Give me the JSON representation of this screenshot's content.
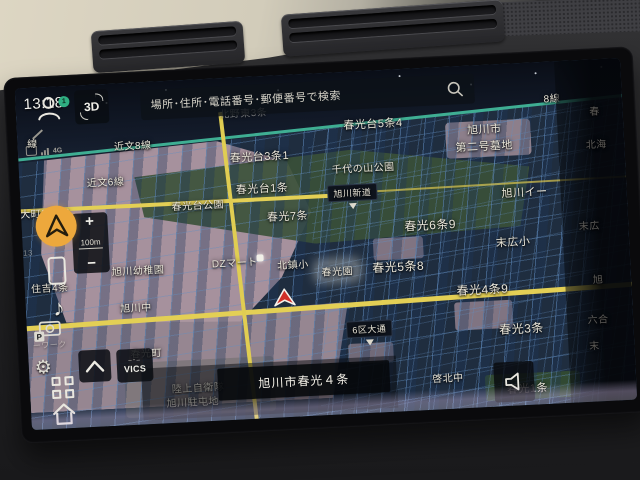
{
  "colors": {
    "accent_orange": "#eda83c",
    "badge_green": "#2fae82",
    "road_yellow": "#e3cf55",
    "road_teal": "#3fae93",
    "map_bg": "#1f2d3f",
    "pink_area": "#b29aa5",
    "park_green": "#3a5138",
    "marker_red": "#d03028"
  },
  "status": {
    "time": "13:18",
    "network_label": "4G"
  },
  "topbar": {
    "view_3d_label": "3D",
    "search_placeholder": "場所･住所･電話番号･郵便番号で検索"
  },
  "zoom_control": {
    "zoom_in": "+",
    "scale": "100m",
    "zoom_out": "−"
  },
  "bottom": {
    "vics_label": "VICS",
    "vics_marks": "–･–",
    "current_address": "旭川市春光４条"
  },
  "sidebar": {
    "profile_badge": "1",
    "music_glyph": "♪"
  },
  "left_icons": {
    "gear_glyph": "⚙",
    "camera_p_label": "P"
  },
  "map": {
    "labels": [
      {
        "t": "線",
        "x": 15,
        "y": 55,
        "c": ""
      },
      {
        "t": "近文8線",
        "x": 115,
        "y": 62,
        "c": ""
      },
      {
        "t": "北野東3条",
        "x": 227,
        "y": 35,
        "c": "dim"
      },
      {
        "t": "8線",
        "x": 536,
        "y": 36,
        "c": ""
      },
      {
        "t": "春光台5条4",
        "x": 356,
        "y": 53,
        "c": "lg"
      },
      {
        "t": "旭川市",
        "x": 467,
        "y": 64,
        "c": "lg"
      },
      {
        "t": "第二号墓地",
        "x": 466,
        "y": 81,
        "c": "lg"
      },
      {
        "t": "春光台3条1",
        "x": 241,
        "y": 80,
        "c": "lg"
      },
      {
        "t": "近文6線",
        "x": 86,
        "y": 97,
        "c": ""
      },
      {
        "t": "千代の山公園",
        "x": 344,
        "y": 96,
        "c": ""
      },
      {
        "t": "春光台1条",
        "x": 242,
        "y": 112,
        "c": "lg"
      },
      {
        "t": "春光台公園",
        "x": 177,
        "y": 125,
        "c": ""
      },
      {
        "t": "春光7条",
        "x": 266,
        "y": 141,
        "c": "lg"
      },
      {
        "t": "大町2条18",
        "x": 24,
        "y": 125,
        "c": ""
      },
      {
        "t": "旭川イー",
        "x": 504,
        "y": 129,
        "c": "lg"
      },
      {
        "t": "旭川新道",
        "x": 332,
        "y": 121,
        "c": "sign"
      },
      {
        "t": "春光6条9",
        "x": 408,
        "y": 157,
        "c": "xl"
      },
      {
        "t": "末広小",
        "x": 490,
        "y": 178,
        "c": "lg"
      },
      {
        "t": "13",
        "x": 5,
        "y": 165,
        "c": "dim sm"
      },
      {
        "t": "DZマート",
        "x": 211,
        "y": 184,
        "c": ""
      },
      {
        "t": "北鎮小",
        "x": 269,
        "y": 189,
        "c": ""
      },
      {
        "t": "春光園",
        "x": 313,
        "y": 198,
        "c": "glow"
      },
      {
        "t": "春光5条8",
        "x": 374,
        "y": 197,
        "c": "xl"
      },
      {
        "t": "住吉4条",
        "x": 25,
        "y": 200,
        "c": ""
      },
      {
        "t": "旭川幼稚園",
        "x": 114,
        "y": 187,
        "c": ""
      },
      {
        "t": "春光4条9",
        "x": 457,
        "y": 224,
        "c": "xl"
      },
      {
        "t": "旭川中",
        "x": 110,
        "y": 224,
        "c": ""
      },
      {
        "t": "ーワーク",
        "x": 22,
        "y": 258,
        "c": "dim sm"
      },
      {
        "t": "6区大通",
        "x": 342,
        "y": 258,
        "c": "sign"
      },
      {
        "t": "春光3条",
        "x": 494,
        "y": 265,
        "c": "xl"
      },
      {
        "t": "春光町",
        "x": 118,
        "y": 270,
        "c": ""
      },
      {
        "t": "啓北中",
        "x": 418,
        "y": 310,
        "c": ""
      },
      {
        "t": "陸上自衛隊",
        "x": 168,
        "y": 307,
        "c": ""
      },
      {
        "t": "旭川駐屯地",
        "x": 162,
        "y": 321,
        "c": ""
      },
      {
        "t": "春光1条",
        "x": 497,
        "y": 325,
        "c": "lg"
      },
      {
        "t": "春",
        "x": 578,
        "y": 51,
        "c": "fade"
      },
      {
        "t": "北海",
        "x": 578,
        "y": 84,
        "c": "fade"
      },
      {
        "t": "末広",
        "x": 567,
        "y": 165,
        "c": "fade"
      },
      {
        "t": "旭",
        "x": 573,
        "y": 219,
        "c": "fade"
      },
      {
        "t": "六合",
        "x": 571,
        "y": 259,
        "c": "fade"
      },
      {
        "t": "末",
        "x": 566,
        "y": 285,
        "c": "fade"
      }
    ]
  }
}
